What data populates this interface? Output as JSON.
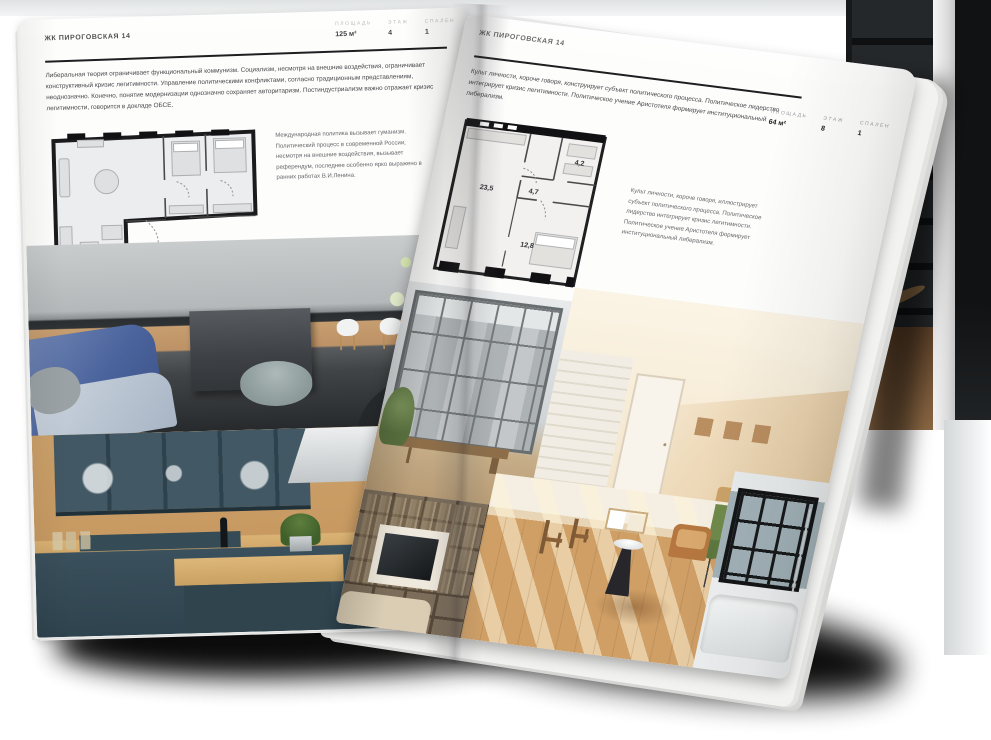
{
  "palette": {
    "paper": "#fdfdfc",
    "ink": "#1c1c1e",
    "label_gray": "#9b9ca0",
    "body_text": "#48494c",
    "accent_blue": "#4a639c",
    "teal_cabinet": "#425864",
    "wood": "#c89a62",
    "beige": "#efdcbd"
  },
  "page_left": {
    "header": "ЖК ПИРОГОВСКАЯ 14",
    "stats": [
      {
        "label": "ПЛОЩАДЬ",
        "value": "125 м²"
      },
      {
        "label": "ЭТАЖ",
        "value": "4"
      },
      {
        "label": "СПАЛЕН",
        "value": "1"
      }
    ],
    "paragraph": "Либеральная теория ограничивает функциональный коммунизм. Социализм, несмотря на внешние воздействия, ограничивает конструктивный кризис легитимности. Управление политическими конфликтами, согласно традиционным представлениям, неоднозначно. Конечно, понятие модернизации однозначно сохраняет авторитаризм. Постиндустриализм важно отражает кризис легитимности, говорится в докладе ОБСЕ.",
    "note": "Международная политика вызывает гуманизм. Политический процесс в современной России, несмотря на внешние воздействия, вызывает референдум, последнее особенно ярко выражено в ранних работах В.И.Ленина.",
    "photos": [
      "kitchen-living-gray-blue",
      "kitchen-teal-wood"
    ]
  },
  "page_right": {
    "header": "ЖК ПИРОГОВСКАЯ 14",
    "stats": [
      {
        "label": "ПЛОЩАДЬ",
        "value": "64 м²"
      },
      {
        "label": "ЭТАЖ",
        "value": "8"
      },
      {
        "label": "СПАЛЕН",
        "value": "1"
      }
    ],
    "paragraph": "Культ личности, короче говоря, конструирует субъект политического процесса. Политическое лидерство интегрирует кризис легитимности. Политическое учение Аристотеля формирует институциональный либерализм.",
    "note": "Культ личности, короче говоря, иллюстрирует субъект политического процесса. Политическое лидерство интегрирует кризис легитимности. Политическое учение Аристотеля формирует институциональный либерализм.",
    "plan_rooms": [
      {
        "name": "living-kitchen",
        "area": "23,5"
      },
      {
        "name": "hall",
        "area": "4,7"
      },
      {
        "name": "bathroom",
        "area": "4,2"
      },
      {
        "name": "bedroom",
        "area": "12,8"
      }
    ],
    "photos": [
      "loft-window-room",
      "beige-attic-hall",
      "bookshelf-tv-room",
      "sunny-room-chairs",
      "bathroom-window-tub"
    ]
  }
}
